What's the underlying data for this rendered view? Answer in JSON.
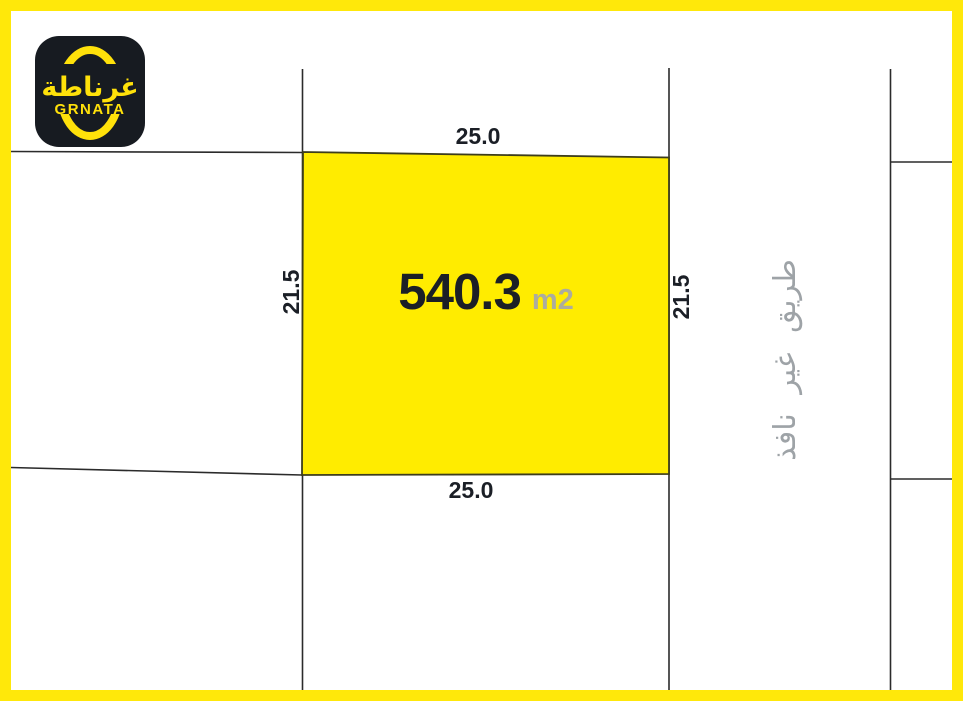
{
  "map": {
    "frame_color": "#FFE80A",
    "background": "#FFFFFF",
    "line_color": "#2B2B2B"
  },
  "logo": {
    "brand_arabic": "غرناطة",
    "brand_latin": "GRNATA",
    "background": "#171B21",
    "accent": "#FFE10A"
  },
  "parcel": {
    "area": "540.3",
    "unit": "m2",
    "fill": "#FFEC00",
    "dim_top": "25.0",
    "dim_bottom": "25.0",
    "dim_left": "21.5",
    "dim_right": "21.5"
  },
  "road": {
    "label": "طريق غير نافذ",
    "color": "#9EA3A7"
  }
}
